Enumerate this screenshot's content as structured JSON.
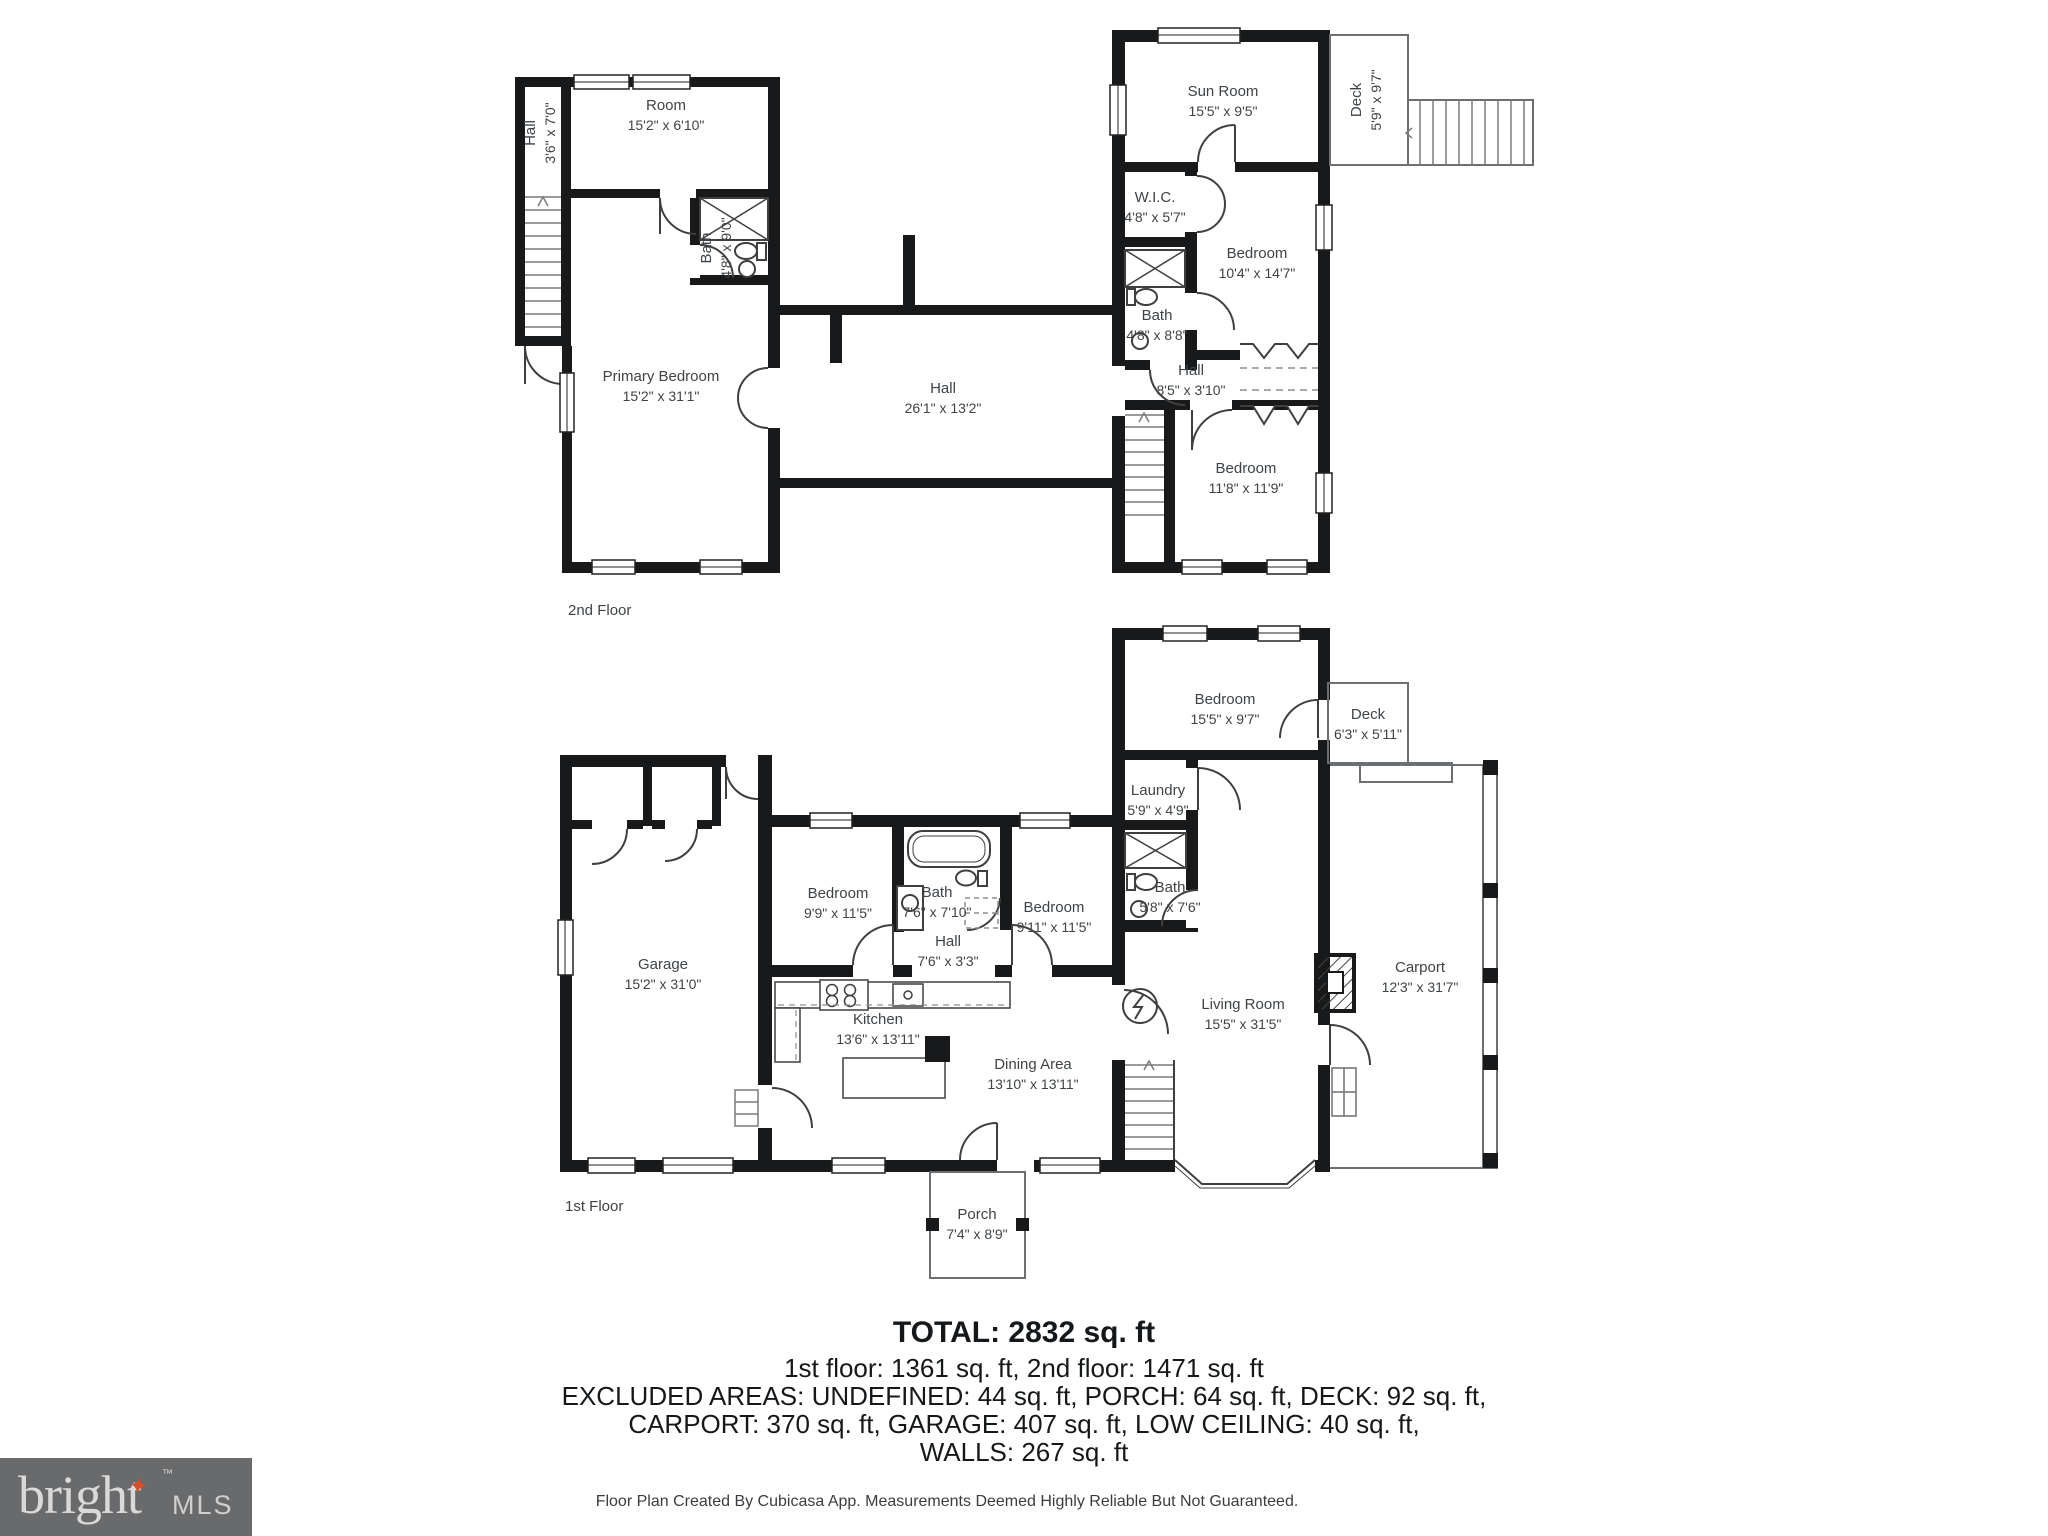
{
  "floors": [
    {
      "label": "2nd Floor",
      "rooms": [
        {
          "name": "Hall",
          "dims": "3'6\" x 7'0\""
        },
        {
          "name": "Room",
          "dims": "15'2\" x 6'10\""
        },
        {
          "name": "Bath",
          "dims": "4'8\" x 9'0\""
        },
        {
          "name": "Primary Bedroom",
          "dims": "15'2\" x 31'1\""
        },
        {
          "name": "Hall",
          "dims": "26'1\" x 13'2\""
        },
        {
          "name": "Sun Room",
          "dims": "15'5\" x 9'5\""
        },
        {
          "name": "Deck",
          "dims": "5'9\" x 9'7\""
        },
        {
          "name": "W.I.C.",
          "dims": "4'8\" x 5'7\""
        },
        {
          "name": "Bedroom",
          "dims": "10'4\" x 14'7\""
        },
        {
          "name": "Bath",
          "dims": "4'8\" x 8'8\""
        },
        {
          "name": "Hall",
          "dims": "8'5\" x 3'10\""
        },
        {
          "name": "Bedroom",
          "dims": "11'8\" x 11'9\""
        }
      ]
    },
    {
      "label": "1st Floor",
      "rooms": [
        {
          "name": "Bedroom",
          "dims": "15'5\" x 9'7\""
        },
        {
          "name": "Deck",
          "dims": "6'3\" x 5'11\""
        },
        {
          "name": "Laundry",
          "dims": "5'9\" x 4'9\""
        },
        {
          "name": "Bath",
          "dims": "5'8\" x 7'6\""
        },
        {
          "name": "Garage",
          "dims": "15'2\" x 31'0\""
        },
        {
          "name": "Bedroom",
          "dims": "9'9\" x 11'5\""
        },
        {
          "name": "Bath",
          "dims": "7'6\" x 7'10\""
        },
        {
          "name": "Hall",
          "dims": "7'6\" x 3'3\""
        },
        {
          "name": "Bedroom",
          "dims": "9'11\" x 11'5\""
        },
        {
          "name": "Living Room",
          "dims": "15'5\" x 31'5\""
        },
        {
          "name": "Carport",
          "dims": "12'3\" x 31'7\""
        },
        {
          "name": "Kitchen",
          "dims": "13'6\" x 13'11\""
        },
        {
          "name": "Dining Area",
          "dims": "13'10\" x 13'11\""
        },
        {
          "name": "Porch",
          "dims": "7'4\" x 8'9\""
        }
      ]
    }
  ],
  "summary": {
    "total": "TOTAL: 2832 sq. ft",
    "line2": "1st floor: 1361 sq. ft, 2nd floor: 1471 sq. ft",
    "line3": "EXCLUDED AREAS: UNDEFINED: 44 sq. ft, PORCH: 64 sq. ft, DECK: 92 sq. ft,",
    "line4": "CARPORT: 370 sq. ft, GARAGE: 407 sq. ft, LOW CEILING: 40 sq. ft,",
    "line5": "WALLS: 267 sq. ft"
  },
  "footer": {
    "disclaimer": "Floor Plan Created By Cubicasa App. Measurements Deemed Highly Reliable But Not Guaranteed."
  },
  "logo": {
    "brand": "bright",
    "tm": "™",
    "star": "✦",
    "suffix": "MLS",
    "background": "#696a6c",
    "text_color": "#d9d9d9",
    "star_color": "#d6502c"
  },
  "colors": {
    "walls": "#17191b",
    "label_text": "#3e4347",
    "thin_outline": "#6b6f72"
  }
}
